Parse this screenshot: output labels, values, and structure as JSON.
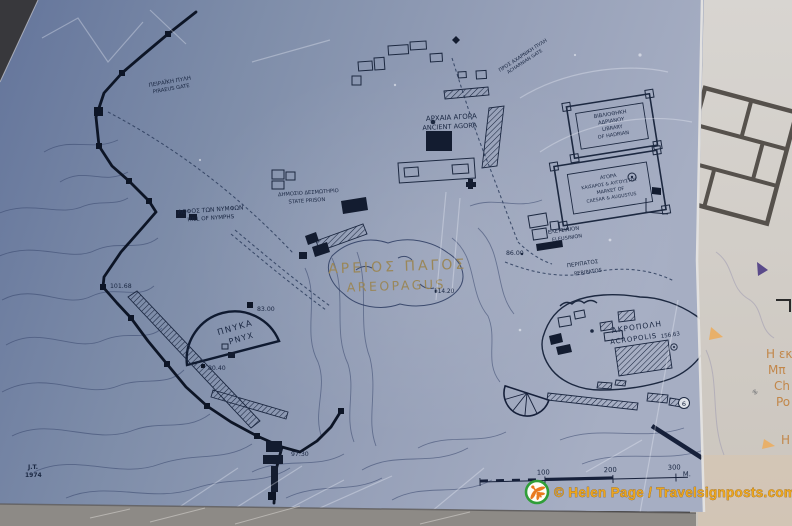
{
  "sign": {
    "labels": {
      "piraeus_gate": {
        "el": "ΠΕΙΡΑΪΚΗ ΠΥΛΗ",
        "en": "PIRAEUS GATE"
      },
      "acharnian_gate": {
        "el": "ΠΡΟΣ ΑΧΑΡΝΙΚΗ ΠΥΛΗ",
        "en": "ACHARNIAN GATE"
      },
      "hill_of_nymphs": {
        "el": "ΛΟΦΟΣ ΤΩΝ ΝΥΜΦΩΝ",
        "en": "HILL OF NYMPHS"
      },
      "ancient_agora": {
        "el": "ΑΡΧΑΙΑ ΑΓΟΡΑ",
        "en": "ANCIENT AGORA"
      },
      "state_prison": {
        "el": "ΔΗΜΟΣΙΟ ΔΕΣΜΩΤΗΡΙΟ",
        "en": "STATE PRISON"
      },
      "areopagus": {
        "el": "ΑΡΕΙΟΣ ΠΑΓΟΣ",
        "en": "AREOPAGUS"
      },
      "pnyx": {
        "el": "ΠΝΥΚΑ",
        "en": "PNYX"
      },
      "eleusinion": {
        "el": "ΕΛΕΥΣΙΝΙΟΝ",
        "en": "ELEUSINION"
      },
      "peripatos": {
        "el": "ΠΕΡΙΠΑΤΟΣ",
        "en": "PERIPATOS"
      },
      "acropolis": {
        "el": "ΑΚΡΟΠΟΛΗ",
        "en": "ACROPOLIS"
      },
      "hadrian_library": {
        "lines": [
          "ΒΙΒΛΙΟΘΗΚΗ",
          "ΑΔΡΙΑΝΟΥ",
          "LIBRARY",
          "OF HADRIAN"
        ]
      },
      "roman_agora": {
        "lines": [
          "ΑΓΟΡΑ",
          "ΚΑΙΣΑΡΟΣ & ΑΥΓΟΥΣΤΟΥ",
          "MARKET OF",
          "CAESAR & AUGUSTUS"
        ]
      }
    },
    "elevations": {
      "hill_of_nymphs": "101.68",
      "pnyx_crest": "83.00",
      "pnyx_terrace": "80.40",
      "south_gate": "97.30",
      "areopagus": "114.20",
      "eleusinion": "86.00",
      "acropolis": "156.63"
    },
    "markers": {
      "theatre_number": "6"
    },
    "scale_bar": {
      "ticks": [
        "100",
        "200",
        "300"
      ],
      "unit": "M."
    },
    "signature": {
      "line1": "J.T.",
      "line2": "1974"
    }
  },
  "side_panel": {
    "partial_text": [
      "Η εκ",
      "Μπ",
      "Ch",
      "Po",
      "Η"
    ]
  },
  "overlay": {
    "copyright": "© Helen Page / Travelsignposts.com"
  },
  "colors": {
    "sign_blue": "#8292ac",
    "ink": "#17233c",
    "bronze_label": "#9a8759",
    "copyright_orange": "#eca61e",
    "logo_green": "#2f9e38",
    "logo_orange": "#e87a1e"
  }
}
